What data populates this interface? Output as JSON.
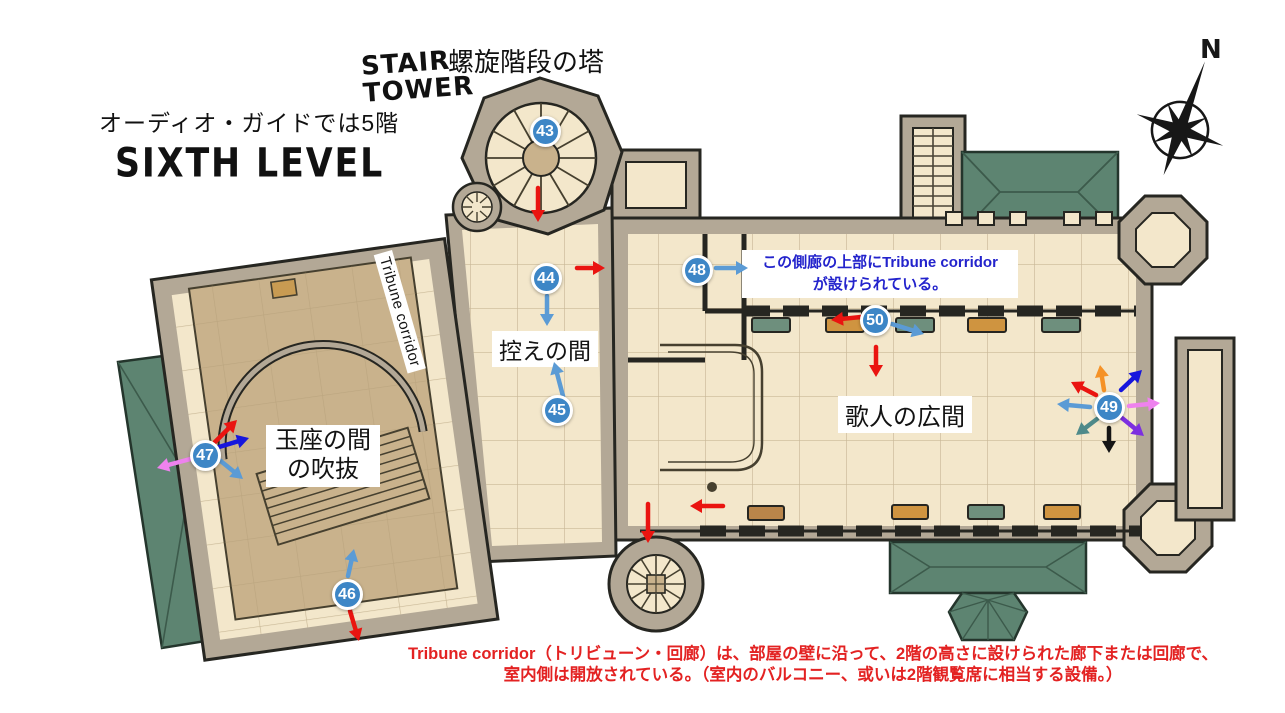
{
  "header": {
    "audio_guide_note": "オーディオ・ガイドでは5階",
    "level_title": "SIXTH LEVEL",
    "stair_tower_line1": "STAIR",
    "stair_tower_line2": "TOWER",
    "stair_tower_jp": "螺旋階段の塔",
    "compass_north": "N"
  },
  "rooms": {
    "anteroom": "控えの間",
    "throne_void_line1": "玉座の間",
    "throne_void_line2": "の吹抜",
    "singers_hall": "歌人の広間",
    "tribune_corridor": "Tribune corridor"
  },
  "notes": {
    "aisle_note_line1": "この側廊の上部にTribune corridor",
    "aisle_note_line2": "が設けられている。",
    "footer_line1": "Tribune corridor（トリビューン・回廊）は、部屋の壁に沿って、2階の高さに設けられた廊下または回廊で、",
    "footer_line2": "室内側は開放されている。（室内のバルコニー、或いは2階観覧席に相当する設備。）"
  },
  "markers": [
    {
      "number": "43",
      "x": 545,
      "y": 131
    },
    {
      "number": "44",
      "x": 546,
      "y": 278
    },
    {
      "number": "45",
      "x": 557,
      "y": 410
    },
    {
      "number": "46",
      "x": 347,
      "y": 594
    },
    {
      "number": "47",
      "x": 205,
      "y": 455
    },
    {
      "number": "48",
      "x": 697,
      "y": 270
    },
    {
      "number": "49",
      "x": 1109,
      "y": 407
    },
    {
      "number": "50",
      "x": 875,
      "y": 320
    }
  ],
  "arrow_colors": {
    "red": "#ea1410",
    "lightblue": "#5b9bd5",
    "darkblue": "#1616dd",
    "pink": "#ee82ee",
    "orange": "#f59227",
    "teal": "#4e8a8a",
    "purple": "#7d2fe0",
    "black": "#151515"
  },
  "arrows": [
    {
      "x1": 538,
      "y1": 188,
      "x2": 538,
      "y2": 222,
      "color": "red"
    },
    {
      "x1": 577,
      "y1": 268,
      "x2": 605,
      "y2": 268,
      "color": "red"
    },
    {
      "x1": 547,
      "y1": 296,
      "x2": 547,
      "y2": 326,
      "color": "lightblue"
    },
    {
      "x1": 563,
      "y1": 396,
      "x2": 554,
      "y2": 362,
      "color": "lightblue"
    },
    {
      "x1": 716,
      "y1": 268,
      "x2": 748,
      "y2": 268,
      "color": "lightblue"
    },
    {
      "x1": 861,
      "y1": 317,
      "x2": 831,
      "y2": 320,
      "color": "red"
    },
    {
      "x1": 892,
      "y1": 324,
      "x2": 924,
      "y2": 334,
      "color": "lightblue"
    },
    {
      "x1": 876,
      "y1": 347,
      "x2": 876,
      "y2": 377,
      "color": "red"
    },
    {
      "x1": 348,
      "y1": 576,
      "x2": 354,
      "y2": 549,
      "color": "lightblue"
    },
    {
      "x1": 350,
      "y1": 611,
      "x2": 359,
      "y2": 641,
      "color": "red"
    },
    {
      "x1": 215,
      "y1": 442,
      "x2": 237,
      "y2": 420,
      "color": "red"
    },
    {
      "x1": 219,
      "y1": 447,
      "x2": 249,
      "y2": 438,
      "color": "darkblue"
    },
    {
      "x1": 194,
      "y1": 458,
      "x2": 157,
      "y2": 468,
      "color": "pink"
    },
    {
      "x1": 217,
      "y1": 458,
      "x2": 243,
      "y2": 479,
      "color": "lightblue"
    },
    {
      "x1": 1096,
      "y1": 395,
      "x2": 1071,
      "y2": 382,
      "color": "red"
    },
    {
      "x1": 1104,
      "y1": 390,
      "x2": 1100,
      "y2": 365,
      "color": "orange"
    },
    {
      "x1": 1121,
      "y1": 390,
      "x2": 1142,
      "y2": 370,
      "color": "darkblue"
    },
    {
      "x1": 1090,
      "y1": 407,
      "x2": 1057,
      "y2": 404,
      "color": "lightblue"
    },
    {
      "x1": 1129,
      "y1": 406,
      "x2": 1160,
      "y2": 403,
      "color": "pink"
    },
    {
      "x1": 1097,
      "y1": 419,
      "x2": 1076,
      "y2": 435,
      "color": "teal"
    },
    {
      "x1": 1109,
      "y1": 428,
      "x2": 1109,
      "y2": 453,
      "color": "black"
    },
    {
      "x1": 1122,
      "y1": 418,
      "x2": 1144,
      "y2": 436,
      "color": "purple"
    },
    {
      "x1": 648,
      "y1": 504,
      "x2": 648,
      "y2": 543,
      "color": "red"
    },
    {
      "x1": 723,
      "y1": 506,
      "x2": 690,
      "y2": 506,
      "color": "red"
    }
  ],
  "palette": {
    "marker_blue": "#3d86c6",
    "floor_cream": "#f3e7cb",
    "void_tan": "#c9b28c",
    "wall_stone": "#b3a896",
    "roof_green": "#5d8471",
    "note_blue": "#2323cc",
    "footer_red": "#e32222"
  }
}
